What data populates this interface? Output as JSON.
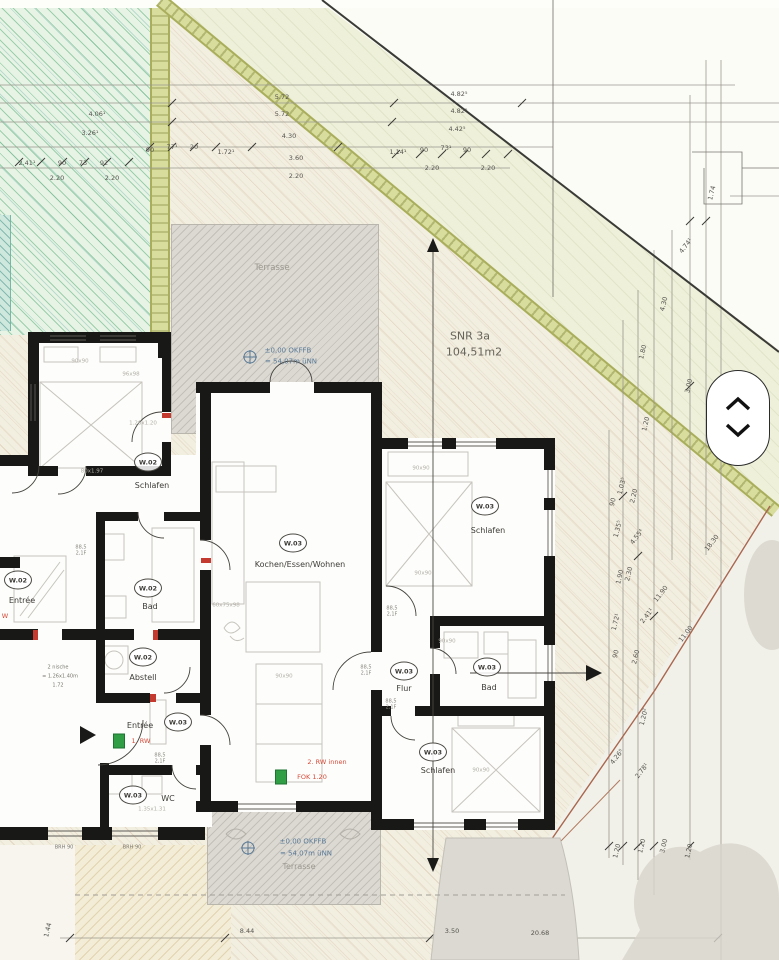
{
  "site": {
    "terrasse_top": "Terrasse",
    "terrasse_bottom": "Terrasse",
    "level_line1": "±0,00 OKFFB",
    "level_line2": "= 54,07m üNN",
    "snr_name": "SNR 3a",
    "snr_area": "104,51m2"
  },
  "rooms": [
    {
      "unit": "W.02",
      "name": "Schlafen"
    },
    {
      "unit": "W.02",
      "name": "Entrée"
    },
    {
      "unit": "W.02",
      "name": "Bad"
    },
    {
      "unit": "W.02",
      "name": "Abstell"
    },
    {
      "unit": "W.03",
      "name": "Entrée"
    },
    {
      "unit": "W.03",
      "name": "WC"
    },
    {
      "unit": "W.03",
      "name": "Kochen/Essen/Wohnen"
    },
    {
      "unit": "W.03",
      "name": "Schlafen"
    },
    {
      "unit": "W.03",
      "name": "Flur"
    },
    {
      "unit": "W.03",
      "name": "Bad"
    },
    {
      "unit": "W.03",
      "name": "Schlafen"
    }
  ],
  "dims_top": [
    "4.06¹",
    "3.26¹",
    "5.72",
    "5.72",
    "4.30",
    "4.82⁵",
    "4.82⁵",
    "4.42⁵",
    "2.41¹",
    "90",
    "73",
    "92",
    "2.20",
    "2.20",
    "90",
    "77¹",
    "20",
    "1.72¹",
    "3.60",
    "2.20",
    "1.14¹",
    "90",
    "73¹",
    "90",
    "2.20",
    "2.20"
  ],
  "dims_right": [
    "1.74",
    "4.74¹",
    "4.30",
    "1.80",
    "3.00",
    "1.20",
    "1.03⁵",
    "90",
    "2.20",
    "1.35⁵",
    "4.55⁴",
    "18.30",
    "2.30",
    "1.90",
    "11.90",
    "2.41¹",
    "1.72¹",
    "11.00",
    "90",
    "2.60",
    "1.20²",
    "4.26⁵",
    "2.78¹",
    "1.20",
    "1.20",
    "3.00",
    "1.20"
  ],
  "dims_bottom": [
    "1.44",
    "8.44",
    "3.50",
    "20.68"
  ],
  "furniture_labels": [
    "90x90",
    "96x98",
    "1.26x1.20",
    "80x1.97",
    "60x75x98",
    "90x90",
    "90x90",
    "90x90",
    "90x90",
    "90x90",
    "1.35x1.31"
  ],
  "door_label": {
    "w": "88,5",
    "c": "2,1F"
  },
  "niche_note": {
    "l1": "2 nische",
    "l2": "= 1.26x1.40m",
    "l3": "1.72"
  },
  "brh_label": "BRH 90",
  "red_notes": {
    "rw2": "2. RW innen",
    "fok": "FOK 1.20",
    "rw1": "1. RW",
    "w": "W"
  },
  "colors": {
    "accent_red": "#d84a38",
    "accent_green": "#2f9e44",
    "wall": "#181816",
    "hedge": "#a9ae5c",
    "boundary": "#a9674f"
  }
}
